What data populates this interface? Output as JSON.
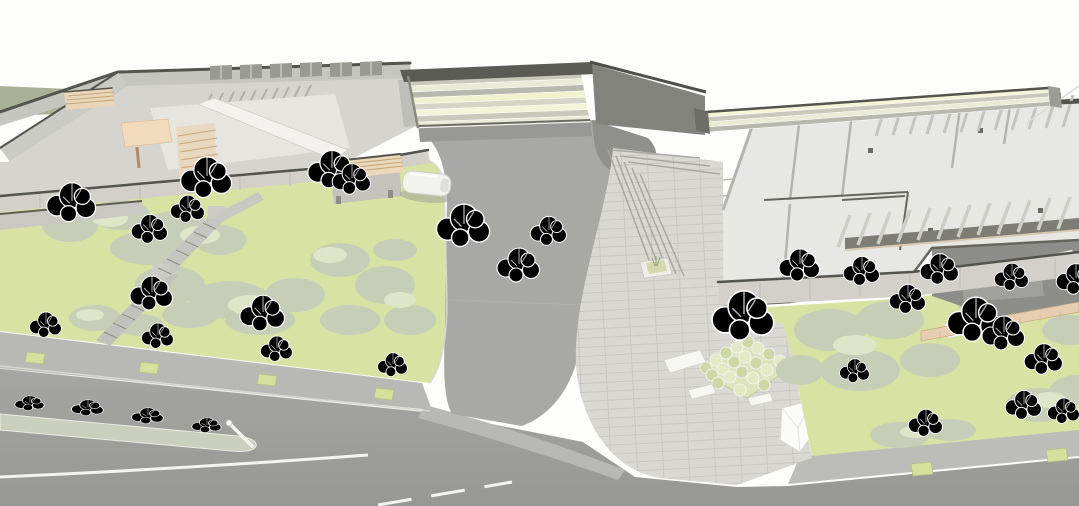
{
  "meta": {
    "title": "Architectural site rendering",
    "description": "Aerial axonometric architectural rendering: cutaway stone buildings flanking a gateway canopy over an access road, a stepped stone plaza with a central tree planter and benches, lawns with clipped hedge clouds and trees, and a tree-lined boulevard with a planted median island."
  },
  "palette": {
    "background": "#fdfdfc",
    "far_grass": "#a9b197",
    "lawn": "#d8e2a3",
    "hedge": "#c7ceb7",
    "hedge_light": "#dee5c8",
    "road": "#a8a8a5",
    "boulevard_top": "#a7a7a4",
    "boulevard_bottom": "#979794",
    "sidewalk": "#b8b8b4",
    "median": "#cbcfbe",
    "marking": "#f4f4f1",
    "plaza": "#d9d8d3",
    "plaza_joint": "#b3b2ac",
    "wall_light": "#d6d4ce",
    "wall_stone": "#d2d0c9",
    "wall_far": "#c6c6c1",
    "wall_nw": "#cbcbc6",
    "floor_west": "#e7e5e0",
    "floor_east": "#e7e7e4",
    "white_wall": "#f3f2ef",
    "parapet": "#54544e",
    "canopy_base": "#e7e8d4",
    "canopy_dark_frame": "#5b5b56",
    "dark_corner": "#83837e",
    "shadow_road": "#989894",
    "timber": "#e9d8c0",
    "peach": "#f2dabc",
    "pergola_wood": "#e9d6ba",
    "terrace": "#8d8d8a",
    "pergola_shadow": "#7d7d76",
    "boardwalk": "#e7ceb2",
    "planter_bed": "#dde4bd",
    "kiosk_base": "#c4c2bb",
    "kiosk_roof": "#ecd9bc",
    "van_body": "#f2f2ef",
    "tree_pit": "#d5df9e"
  },
  "canopy_stripes": [
    "#f3f4d8",
    "#c8c9ba",
    "#e9ebd6",
    "#b8b9ae",
    "#f0f2ce",
    "#d4d5c4"
  ],
  "planter_bump_colors": [
    "#cdd8a6",
    "#e3e9c4"
  ],
  "objects": {
    "buildings": [
      {
        "name": "west-building",
        "note": "stone-clad wing with cutaway roof, skylights, timber courtyard canopy"
      },
      {
        "name": "gateway-canopy",
        "note": "striped slatted roof spanning the access road"
      },
      {
        "name": "screen-wall",
        "note": "slatted stone screen wall east of the gateway"
      },
      {
        "name": "east-building",
        "note": "cutaway interior walls, roof rafters, pergola beams, roof terrace with boardwalk"
      }
    ],
    "landscape": [
      "west-lawn",
      "east-lawn",
      "hedge-clusters",
      "garden-steps",
      "median-island",
      "street-tree-rows"
    ],
    "circulation": [
      "access-road",
      "boulevard",
      "plaza",
      "plaza-steps"
    ],
    "furniture": [
      "kiosk",
      "white-van",
      "lamp-post",
      "plaza-planter",
      "benches",
      "paper-sculpture"
    ],
    "bench_count": 3,
    "street_tree_pit_count": 6
  },
  "trees": [
    [
      72,
      247,
      1.15,
      "g1"
    ],
    [
      150,
      262,
      0.85,
      "g2"
    ],
    [
      207,
      224,
      1.2,
      "g1"
    ],
    [
      188,
      240,
      0.8,
      "g2"
    ],
    [
      152,
      332,
      1.0,
      "g2"
    ],
    [
      263,
      354,
      1.05,
      "g1"
    ],
    [
      332,
      212,
      1.1,
      "g2"
    ],
    [
      352,
      214,
      0.9,
      "g1"
    ],
    [
      464,
      274,
      1.25,
      "g1"
    ],
    [
      519,
      304,
      1.0,
      "g2"
    ],
    [
      549,
      264,
      0.85,
      "g2"
    ],
    [
      46,
      354,
      0.75,
      "s"
    ],
    [
      158,
      365,
      0.75,
      "s"
    ],
    [
      277,
      378,
      0.75,
      "s"
    ],
    [
      393,
      392,
      0.7,
      "s"
    ],
    [
      30,
      420,
      0.6,
      "d"
    ],
    [
      88,
      426,
      0.65,
      "d"
    ],
    [
      148,
      434,
      0.65,
      "d"
    ],
    [
      207,
      442,
      0.6,
      "d"
    ],
    [
      744,
      372,
      1.45,
      "sp"
    ],
    [
      800,
      302,
      0.95,
      "g2"
    ],
    [
      862,
      304,
      0.85,
      "g1"
    ],
    [
      940,
      304,
      0.9,
      "g2"
    ],
    [
      1012,
      308,
      0.8,
      "g1"
    ],
    [
      855,
      398,
      0.7,
      "g3"
    ],
    [
      908,
      332,
      0.85,
      "g1"
    ],
    [
      976,
      370,
      1.3,
      "g1"
    ],
    [
      1004,
      372,
      1.0,
      "g2"
    ],
    [
      1044,
      394,
      0.9,
      "g1"
    ],
    [
      1024,
      438,
      0.85,
      "g2"
    ],
    [
      926,
      454,
      0.8,
      "s"
    ],
    [
      1064,
      440,
      0.75,
      "g1"
    ],
    [
      1076,
      314,
      0.9,
      "g2"
    ]
  ]
}
